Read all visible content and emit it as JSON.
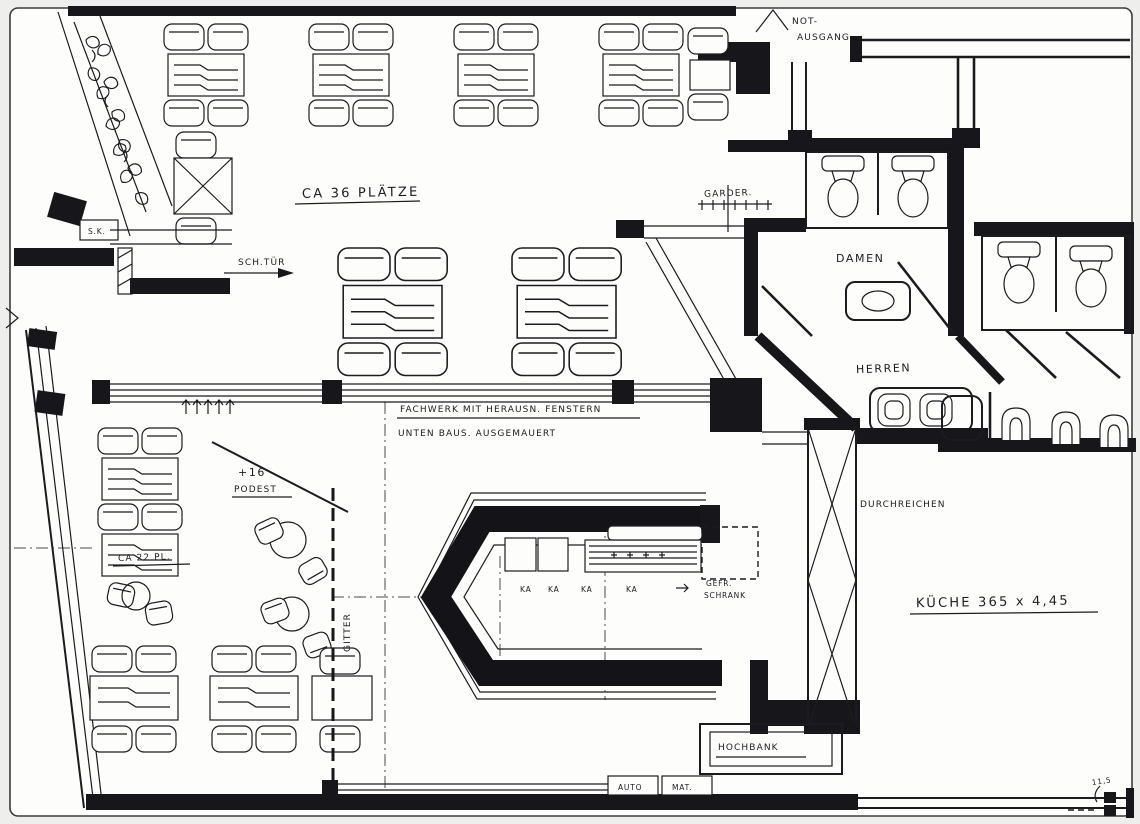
{
  "page": {
    "type": "scanned floor plan",
    "ink_color": "#1c1c20",
    "paper_color": "#fdfdfb"
  },
  "labels": {
    "not_ausgang_line1": "NOT-",
    "not_ausgang_line2": "AUSGANG",
    "seats_36": "CA 36 PLÄTZE",
    "garderobe": "GARDER.",
    "sk": "S.K.",
    "sch_tuer": "SCH.TÜR",
    "damen": "DAMEN",
    "herren": "HERREN",
    "fachwerk": "FACHWERK  MIT  HERAUSN.  FENSTERN",
    "ausgemauert": "UNTEN  BAUS.  AUSGEMAUERT",
    "podest_height": "+16",
    "podest": "PODEST",
    "seats_22": "CA 22 PL.",
    "gitter": "GITTER",
    "ka_1": "KA",
    "ka_2": "KA",
    "ka_3": "KA",
    "ka_4": "KA",
    "gefrierschrank_line1": "GEFR.",
    "gefrierschrank_line2": "SCHRANK",
    "kueche": "KÜCHE  365 x 4,45",
    "durchreichen": "DURCHREICHEN",
    "hochbank": "HOCHBANK",
    "automat_left": "AUTO",
    "automat_right": "MAT.",
    "dim_115": "11,5"
  }
}
